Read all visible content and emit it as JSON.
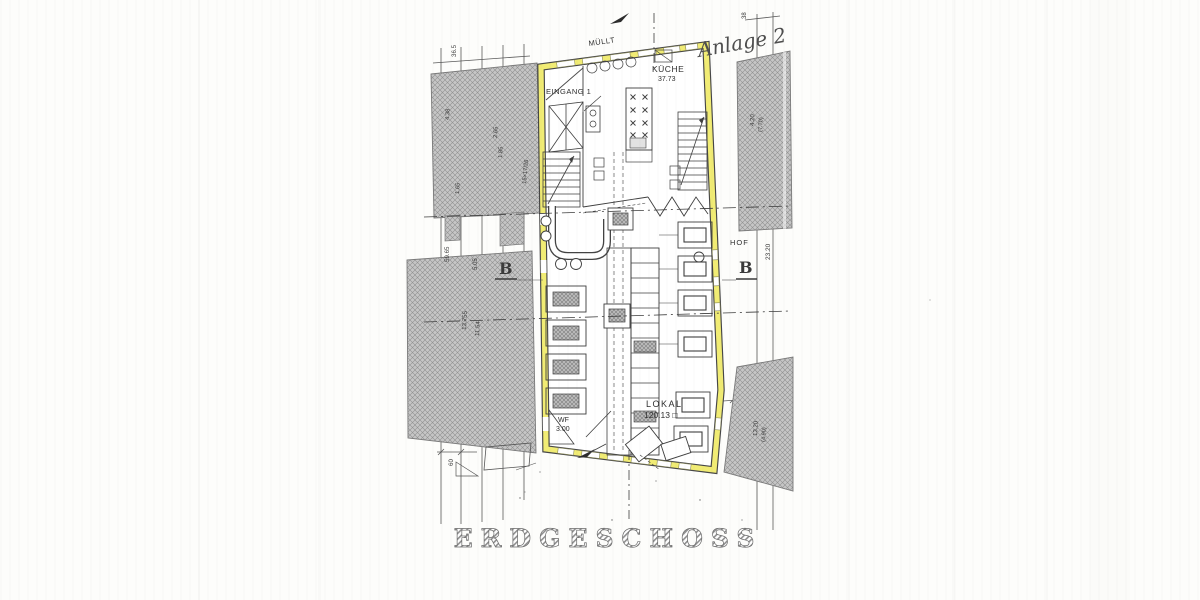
{
  "page": {
    "background": "#fdfdfb",
    "ink": "#3f3f3f",
    "wall_highlight": "#f1ec74",
    "hatch_gray": "#c6c6c6"
  },
  "title": {
    "text": "ERDGESCHOSS"
  },
  "annotations": {
    "handwritten": "Anlage 2",
    "sheet_tick": "38",
    "muell": "MÜLLT",
    "eingang": "EINGANG 1",
    "hof": "HOF",
    "section_left": "B",
    "section_right": "B",
    "stair_note": "15×17/26"
  },
  "rooms": {
    "kueche": {
      "label": "KÜCHE",
      "area": "37.73"
    },
    "lokal": {
      "label": "LOKAL",
      "area": "120.13 □"
    },
    "wf": {
      "label": "WF",
      "value": "3.00"
    }
  },
  "dimensions": {
    "left_top": "36.5",
    "left_a": "59.65",
    "left_b": "5.05",
    "left_c": "13.755",
    "left_d": "11.54",
    "block_a": "4.38",
    "block_b": "2.65",
    "block_c": "1.85",
    "block_d": "1.65",
    "left_bottom": "60",
    "right_a": "4.20",
    "right_b": "(7.70)",
    "hof_depth": "23.20",
    "right_c": "13.20",
    "right_d": "(4.90)"
  }
}
